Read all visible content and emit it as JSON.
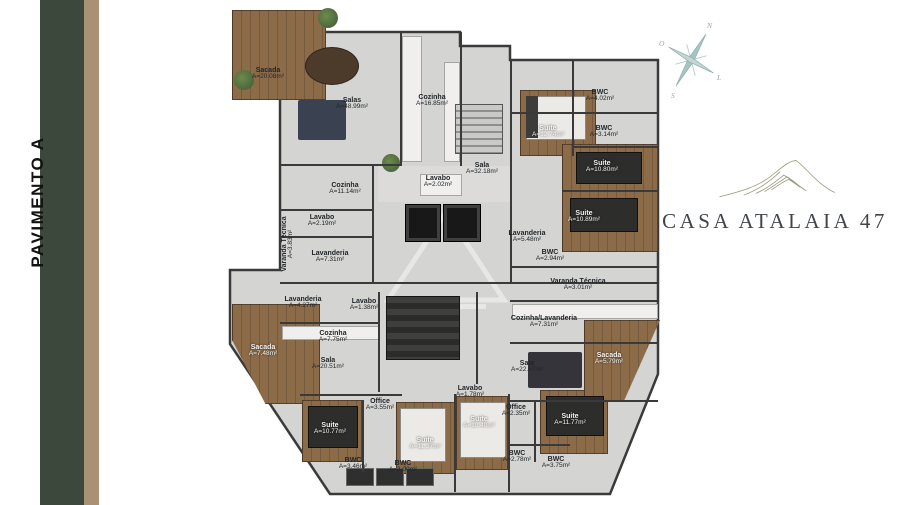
{
  "sidebar": {
    "title": "PAVIMENTO A"
  },
  "brand": {
    "name": "CASA ATALAIA 47"
  },
  "compass": {
    "n": "N",
    "l": "L",
    "s": "S",
    "o": "O"
  },
  "colors": {
    "sidebar_green": "#3d483c",
    "sidebar_tan": "#a99175",
    "floor_gray": "#d4d4d2",
    "wood": "#8c6b49",
    "wall": "#3a3a3a"
  },
  "plan": {
    "rooms": [
      {
        "label": "Sacada",
        "area": "A=20.08m²"
      },
      {
        "label": "Salas",
        "area": "A=48.99m²"
      },
      {
        "label": "Cozinha",
        "area": "A=16.85m²"
      },
      {
        "label": "Lavabo",
        "area": "A=2.02m²"
      },
      {
        "label": "Sala",
        "area": "A=32.18m²"
      },
      {
        "label": "Suite",
        "area": "A=12.74m²"
      },
      {
        "label": "BWC",
        "area": "A=4.02m²"
      },
      {
        "label": "BWC",
        "area": "A=3.14m²"
      },
      {
        "label": "Suite",
        "area": "A=10.80m²"
      },
      {
        "label": "Suite",
        "area": "A=10.89m²"
      },
      {
        "label": "Lavanderia",
        "area": "A=5.48m²"
      },
      {
        "label": "BWC",
        "area": "A=2.94m²"
      },
      {
        "label": "Varanda Técnica",
        "area": "A=3.01m²"
      },
      {
        "label": "Cozinha",
        "area": "A=11.14m²"
      },
      {
        "label": "Lavabo",
        "area": "A=2.19m²"
      },
      {
        "label": "Lavanderia",
        "area": "A=7.31m²"
      },
      {
        "label": "Varanda Técnica",
        "area": "A=3.83m²"
      },
      {
        "label": "Lavanderia",
        "area": "A=4.27m²"
      },
      {
        "label": "Lavabo",
        "area": "A=1.38m²"
      },
      {
        "label": "Cozinha",
        "area": "A=7.75m²"
      },
      {
        "label": "Sala",
        "area": "A=20.51m²"
      },
      {
        "label": "Sacada",
        "area": "A=7.48m²"
      },
      {
        "label": "Suite",
        "area": "A=10.77m²"
      },
      {
        "label": "Office",
        "area": "A=3.55m²"
      },
      {
        "label": "Suite",
        "area": "A=11.37m²"
      },
      {
        "label": "BWC",
        "area": "A=3.46m²"
      },
      {
        "label": "BWC",
        "area": "A=3.00m²"
      },
      {
        "label": "Lavabo",
        "area": "A=1.78m²"
      },
      {
        "label": "Suite",
        "area": "A=10.40m²"
      },
      {
        "label": "Office",
        "area": "A=2.35m²"
      },
      {
        "label": "BWC",
        "area": "A=2.78m²"
      },
      {
        "label": "Suite",
        "area": "A=11.77m²"
      },
      {
        "label": "BWC",
        "area": "A=3.75m²"
      },
      {
        "label": "Cozinha/Lavanderia",
        "area": "A=7.31m²"
      },
      {
        "label": "Sala",
        "area": "A=22.67m²"
      },
      {
        "label": "Sacada",
        "area": "A=5.79m²"
      }
    ]
  }
}
